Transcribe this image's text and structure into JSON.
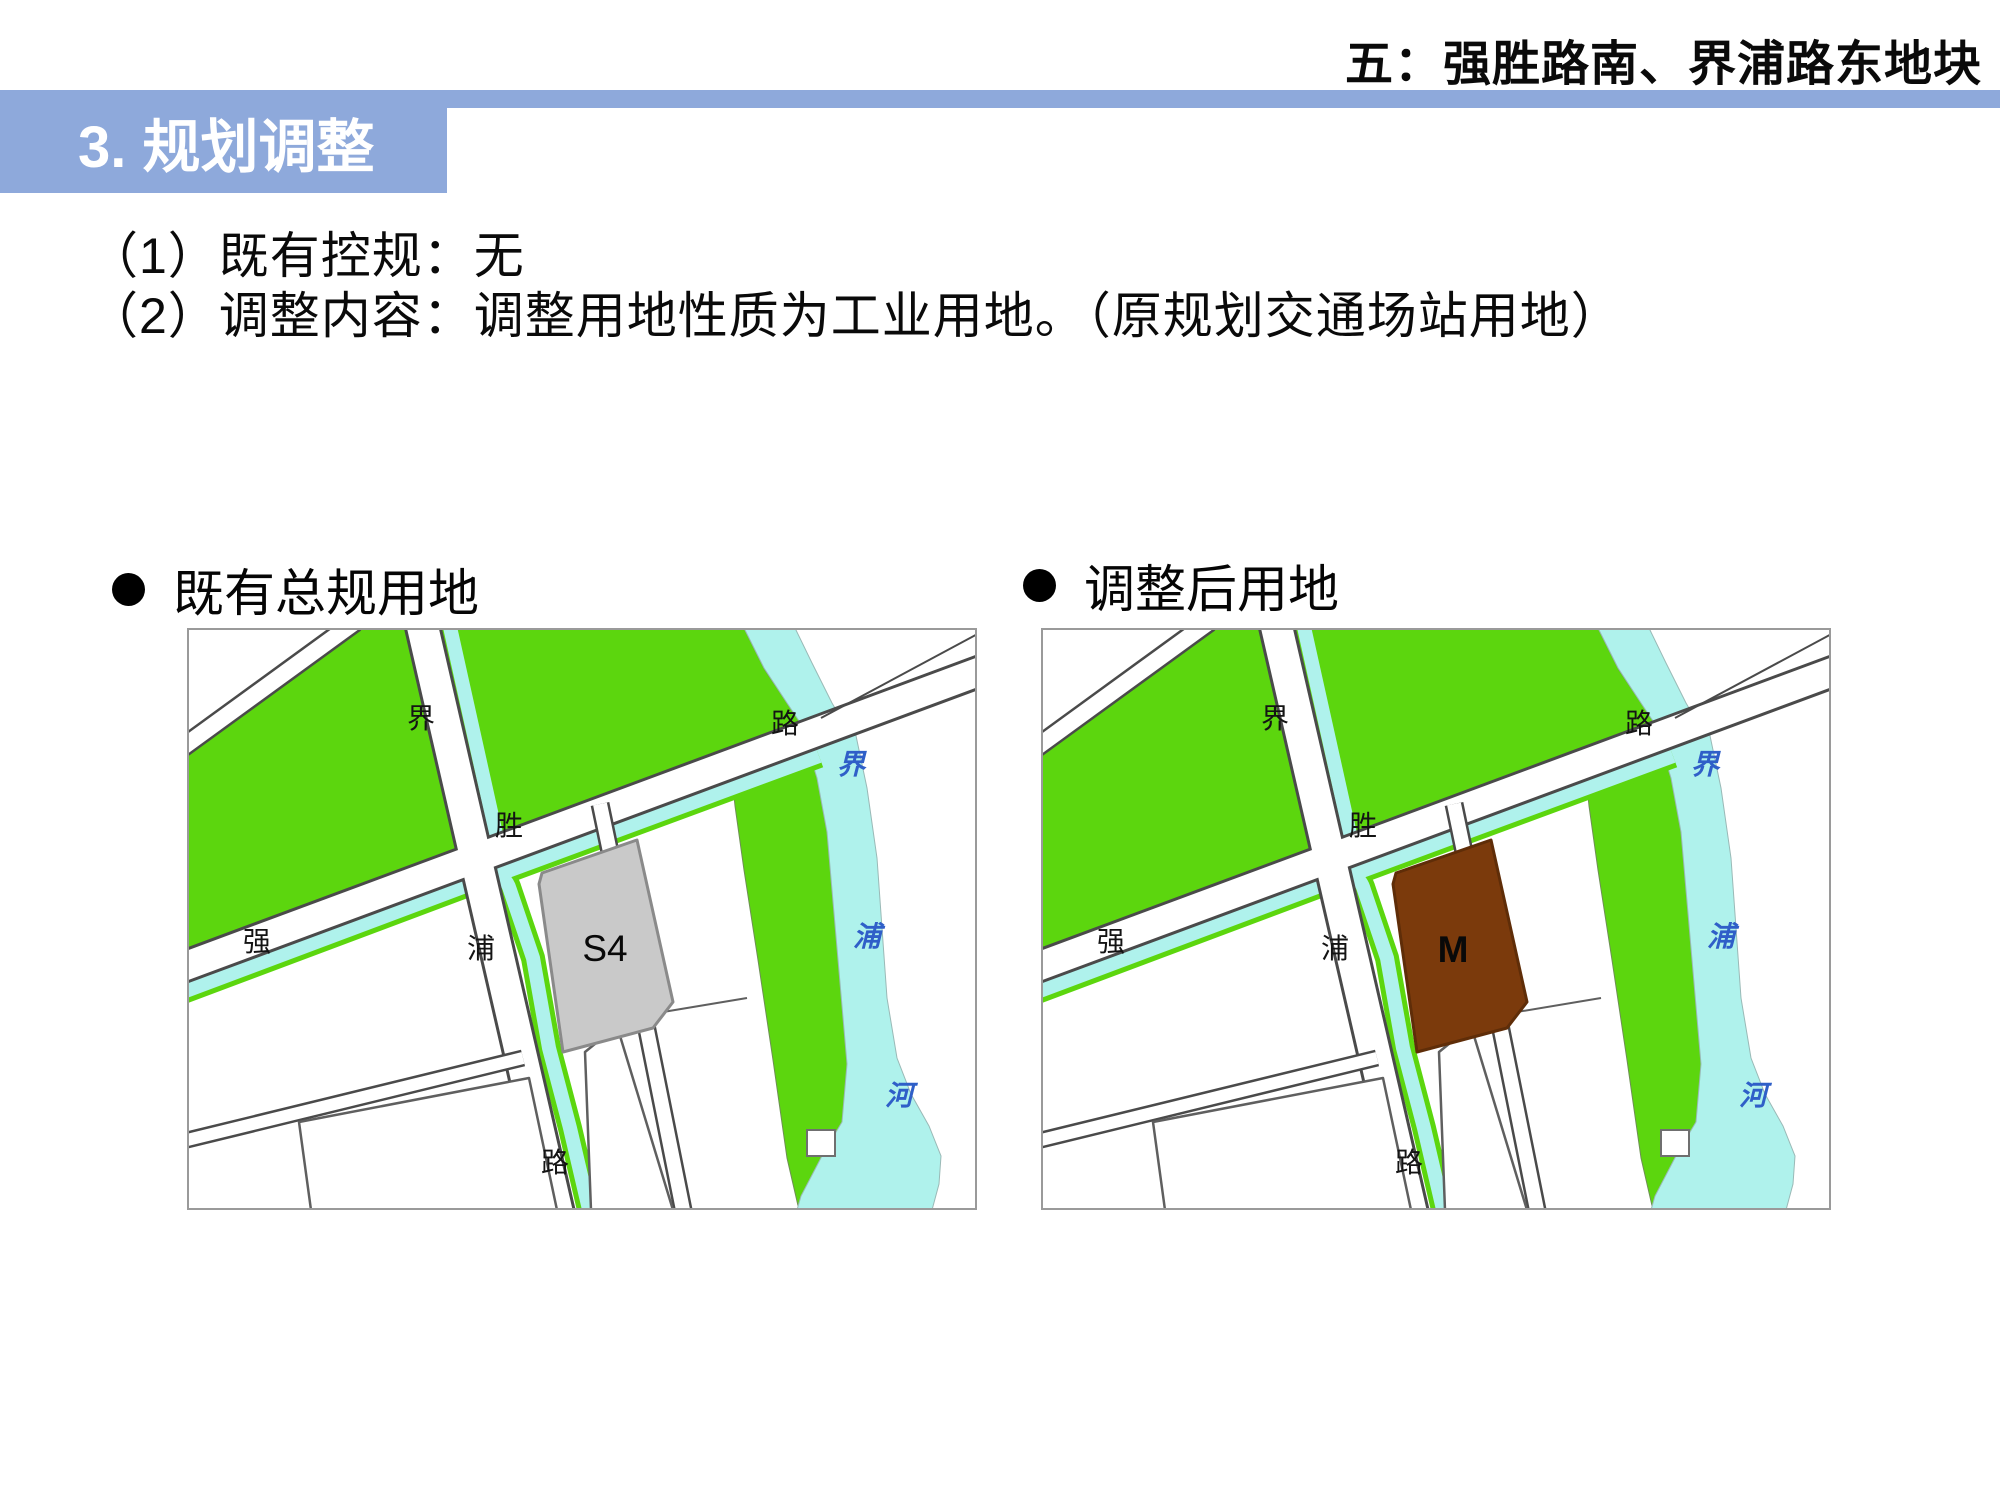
{
  "page": {
    "title": "五：强胜路南、界浦路东地块"
  },
  "banner": {
    "label": "3. 规划调整"
  },
  "body": {
    "line1": "（1）既有控规：无",
    "line2": "（2）调整内容：调整用地性质为工业用地。（原规划交通场站用地）"
  },
  "maps": {
    "before": {
      "heading": "既有总规用地",
      "parcel_label": "S4",
      "parcel_color": "#C9C9C9",
      "parcel_stroke": "#8A8A8A"
    },
    "after": {
      "heading": "调整后用地",
      "parcel_label": "M",
      "parcel_color": "#7B3A0C",
      "parcel_stroke": "#5F2D08"
    },
    "road_labels": {
      "jiepu_road": [
        "界",
        "浦",
        "路"
      ],
      "qiangsheng_road": [
        "强",
        "胜",
        "路"
      ]
    },
    "river_labels": [
      "界",
      "浦",
      "河"
    ]
  },
  "colors": {
    "banner_blue": "#8EA9DB",
    "banner_text": "#FFFFFF",
    "map_green": "#5CD60E",
    "map_water": "#AFF2EC",
    "map_road_outline": "#4A4A4A",
    "parcel_gray": "#C9C9C9",
    "parcel_brown": "#7B3A0C",
    "river_label_blue": "#2F5FC8"
  },
  "icons": {
    "bullet": "filled-circle"
  }
}
